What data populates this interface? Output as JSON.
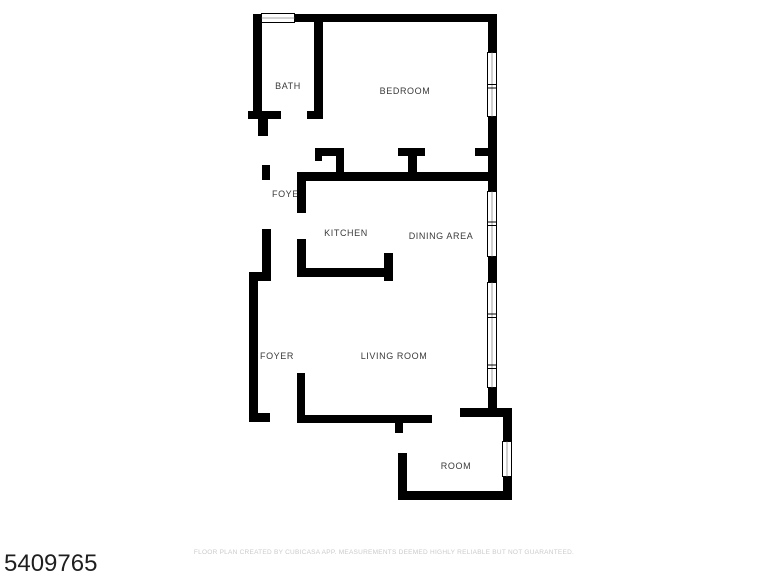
{
  "page": {
    "background": "#ffffff",
    "wall_color": "#000000",
    "label_color": "#3a3a3a"
  },
  "floor_plan": {
    "rooms": [
      {
        "id": "bath",
        "label": "BATH",
        "x": 288,
        "y": 89
      },
      {
        "id": "bedroom",
        "label": "BEDROOM",
        "x": 405,
        "y": 94
      },
      {
        "id": "foyer-upper",
        "label": "FOYER",
        "x": 289,
        "y": 197
      },
      {
        "id": "kitchen",
        "label": "KITCHEN",
        "x": 346,
        "y": 236
      },
      {
        "id": "dining-area",
        "label": "DINING AREA",
        "x": 441,
        "y": 239
      },
      {
        "id": "foyer-lower",
        "label": "FOYER",
        "x": 277,
        "y": 359
      },
      {
        "id": "living-room",
        "label": "LIVING ROOM",
        "x": 394,
        "y": 359
      },
      {
        "id": "room",
        "label": "ROOM",
        "x": 456,
        "y": 469
      }
    ]
  },
  "footer": {
    "listing_id": "5409765",
    "disclaimer": "FLOOR PLAN CREATED BY CUBICASA APP. MEASUREMENTS DEEMED HIGHLY RELIABLE BUT NOT GUARANTEED.",
    "disclaimer_color": "#cbcbcb"
  }
}
